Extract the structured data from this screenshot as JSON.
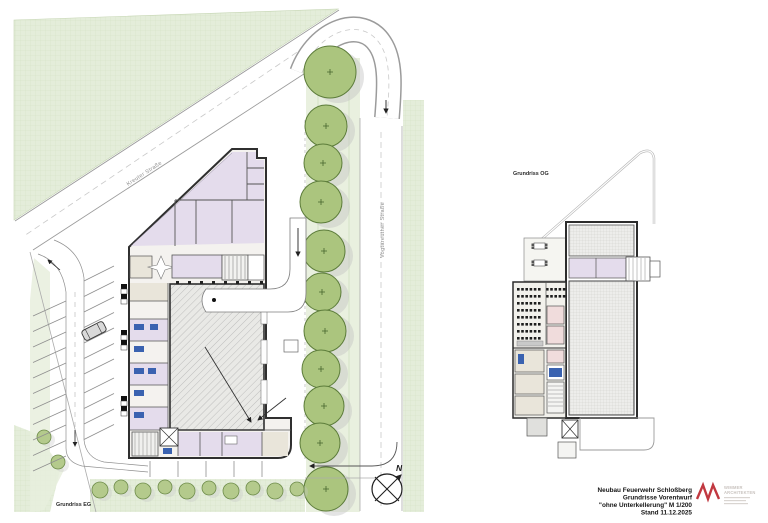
{
  "sheet": {
    "site_plan_label": "Grundriss EG",
    "floor_plan_label": "Grundriss OG",
    "street_diagonal": "Kreuter Straße",
    "street_vertical": "Vogtareuther Straße",
    "north_label": "N"
  },
  "title_block": {
    "project_line1": "Neubau Feuerwehr Schloßberg",
    "project_line2": "Grundrisse Vorentwurf",
    "project_line3": "\"ohne Unterkellerung\"   M 1/200",
    "project_line4": "Stand 11.12.2025",
    "logo_name_line1": "WIMMER",
    "logo_name_line2": "ARCHITEKTEN"
  },
  "colors": {
    "grass": "#e4edda",
    "grass_line": "#d2e1c3",
    "tree_fill": "#abc57e",
    "tree_stroke": "#5c7c3a",
    "room_lilac": "#e4dcec",
    "room_pink": "#f0dcdc",
    "room_beige": "#e9e5da",
    "fixture_blue": "#3a62b0",
    "wall": "#2f2f2f",
    "logo_red": "#c13840"
  },
  "site": {
    "trees": [
      [
        330,
        72,
        26
      ],
      [
        326,
        126,
        21
      ],
      [
        323,
        163,
        19
      ],
      [
        321,
        202,
        21
      ],
      [
        324,
        251,
        21
      ],
      [
        322,
        292,
        19
      ],
      [
        325,
        331,
        21
      ],
      [
        321,
        369,
        19
      ],
      [
        324,
        406,
        20
      ],
      [
        320,
        443,
        20
      ],
      [
        326,
        489,
        22
      ]
    ],
    "bushes": [
      [
        100,
        490,
        8
      ],
      [
        121,
        487,
        7
      ],
      [
        143,
        491,
        8
      ],
      [
        165,
        487,
        7
      ],
      [
        187,
        491,
        8
      ],
      [
        209,
        488,
        7
      ],
      [
        231,
        491,
        8
      ],
      [
        253,
        488,
        7
      ],
      [
        275,
        491,
        8
      ],
      [
        297,
        489,
        7
      ],
      [
        44,
        437,
        7
      ],
      [
        58,
        462,
        7
      ]
    ],
    "parking": {
      "left_row": {
        "x": 66,
        "y": 301,
        "count": 11,
        "step": 15.5,
        "dx": -33,
        "dy": 15
      },
      "right_upper": {
        "x": 84,
        "y": 281,
        "count": 7,
        "step": 15.5,
        "dx": 30,
        "dy": -15
      },
      "right_lower": {
        "x": 84,
        "y": 393,
        "count": 4,
        "step": 15.5,
        "dx": 30,
        "dy": -15
      },
      "south_ticks": {
        "x": 150,
        "y": 461,
        "count": 5,
        "step": 28,
        "len": 16
      }
    },
    "hall_columns": {
      "x": 176,
      "y": 281,
      "count": 8,
      "step": 12,
      "size": 3
    }
  },
  "floor": {
    "seats": {
      "x0": 517,
      "y0": 288,
      "rows": 8,
      "dy": 7,
      "dx": 4.2,
      "left_count": 6,
      "right_x0": 546,
      "right_count": 5,
      "right_rows": 2,
      "size": 2.6
    }
  }
}
